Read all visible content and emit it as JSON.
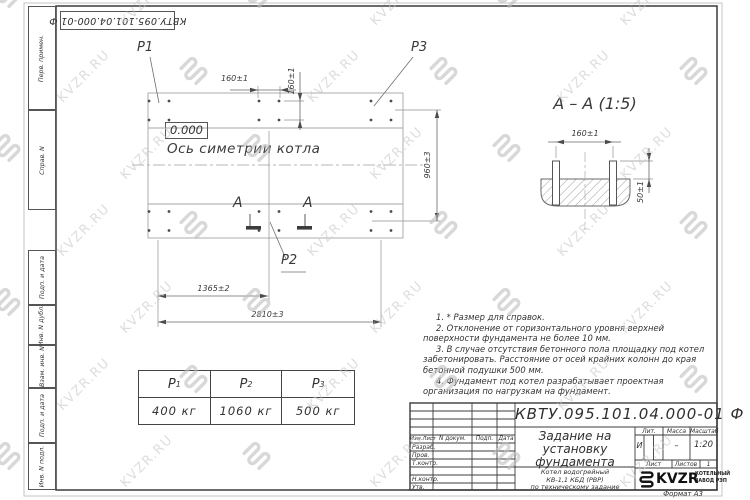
{
  "doc_box": {
    "number": "КВТУ.095.101.04.000-01 Ф"
  },
  "margin": {
    "labels": [
      "Перв. примен.",
      "Справ. N",
      "Подп. и дата",
      "Инв. N дубл.",
      "Взам. инв. N",
      "Подп. и дата",
      "Инв. N подл."
    ]
  },
  "plan": {
    "point_labels": {
      "p1": "P1",
      "p2": "P2",
      "p3": "P3"
    },
    "elevation": "0.000",
    "axis_label": "Ось симетрии котла",
    "section_mark": "A",
    "dims": {
      "bolt_x": "160±1",
      "bolt_y": "160±1",
      "height": "960±3",
      "mid": "1365±2",
      "total": "2810±3"
    }
  },
  "section_view": {
    "title": "A – A (1:5)",
    "dim_width": "160±1",
    "dim_height": "50±1"
  },
  "notes": [
    "1. * Размер для справок.",
    "2. Отклонение от горизонтального уровня верхней поверхности фундамента не более 10 мм.",
    "3. В случае отсутствия бетонного пола площадку под котел забетонировать. Расстояние от осей крайних колонн до края бетонной подушки 500 мм.",
    "4. Фундамент под котел разрабатывает проектная организация по нагрузкам на фундамент."
  ],
  "load_table": {
    "headers": [
      {
        "b": "P",
        "s": "1"
      },
      {
        "b": "P",
        "s": "2"
      },
      {
        "b": "P",
        "s": "3"
      }
    ],
    "values": [
      "400 кг",
      "1060 кг",
      "500 кг"
    ]
  },
  "title_block": {
    "doc_number": "КВТУ.095.101.04.000-01 Ф",
    "title_lines": [
      "Задание на",
      "установку",
      "фундамента"
    ],
    "subtitle_lines": [
      "Котел водогрейный",
      "КВ-1,1 КБД (РВР)",
      "по техническому задание"
    ],
    "header_cols": [
      "Изм.Лист",
      "N докум.",
      "Подп.",
      "Дата"
    ],
    "row_labels": [
      "Разраб.",
      "Пров.",
      "Т.контр.",
      "Н.контр.",
      "Утв."
    ],
    "lit_label": "Лит.",
    "mass_label": "Масса",
    "scale_label": "Масштаб",
    "lit_value": "И",
    "mass_value": "–",
    "scale_value": "1:20",
    "sheet_label": "Лист",
    "sheets_label": "Листов",
    "sheets_value": "1",
    "logo_text": "KVZR",
    "company_lines": [
      "КОТЕЛЬНЫЙ",
      "ЗАВОД РЭП"
    ],
    "format_label": "Формат А3"
  },
  "watermark": {
    "text": "KVZR.RU"
  }
}
